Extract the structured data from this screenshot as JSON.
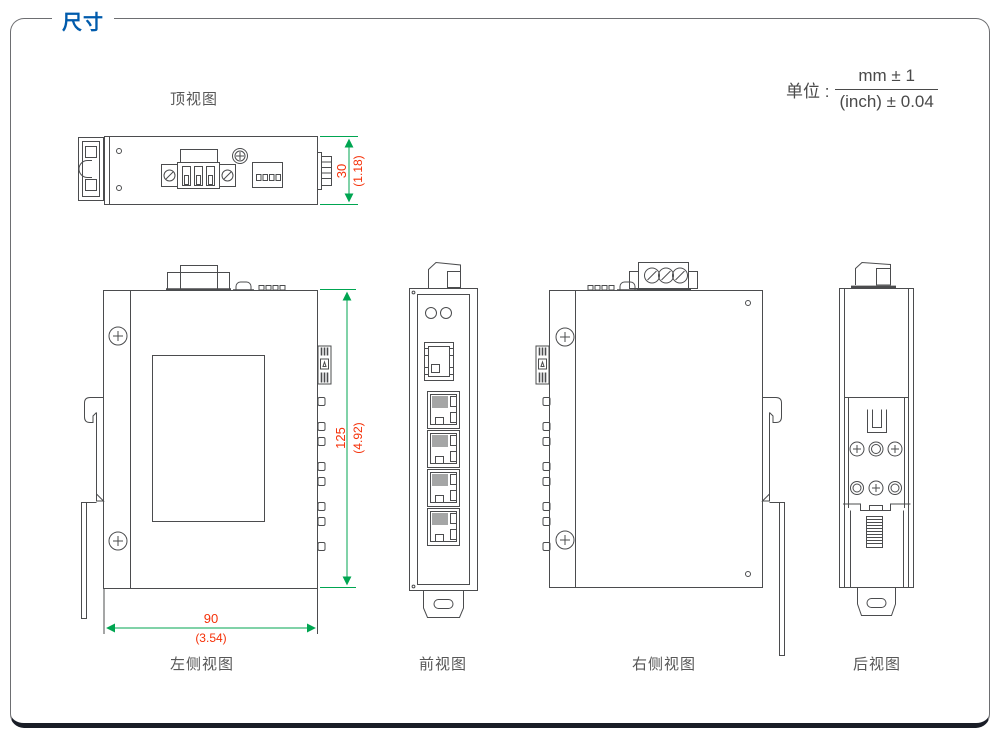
{
  "page": {
    "title": "尺寸"
  },
  "unit": {
    "prefix": "单位 :",
    "numerator": "mm ± 1",
    "denominator": "(inch) ± 0.04"
  },
  "views": {
    "top": {
      "label": "顶视图"
    },
    "left": {
      "label": "左侧视图"
    },
    "front": {
      "label": "前视图"
    },
    "right": {
      "label": "右侧视图"
    },
    "rear": {
      "label": "后视图"
    }
  },
  "dimensions": {
    "height": {
      "mm": "30",
      "inch": "(1.18)"
    },
    "body_height": {
      "mm": "125",
      "inch": "(4.92)"
    },
    "width": {
      "mm": "90",
      "inch": "(3.54)"
    }
  },
  "colors": {
    "title_blue": "#005bac",
    "dim_line_green": "#00a551",
    "dim_text_red": "#f53008",
    "drawing_line": "#4b4c4e",
    "label_gray": "#575757",
    "footer_bar": "#191d26"
  }
}
